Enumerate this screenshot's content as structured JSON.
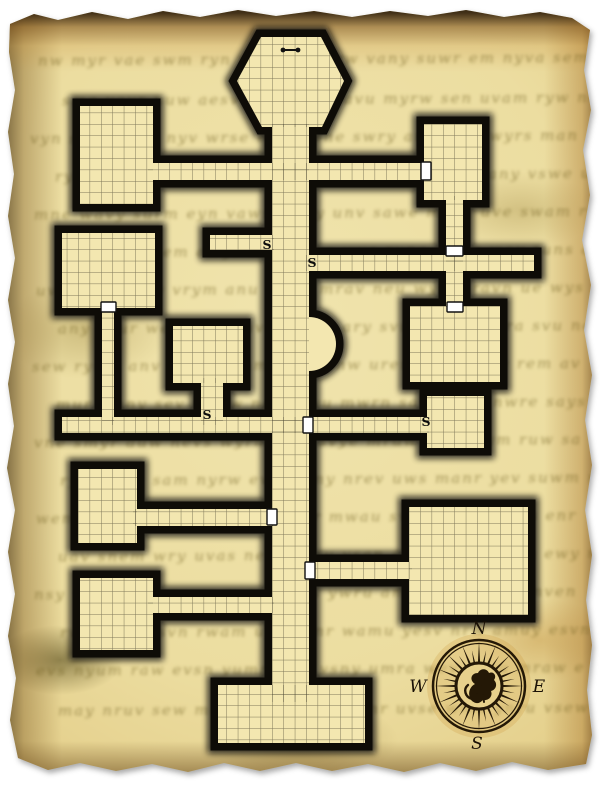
{
  "parchment": {
    "scribbles": [
      {
        "x": 38,
        "y": 50,
        "text": "nw myr vae swm ryn wav emsy rw vany suwr em nyva sem"
      },
      {
        "x": 62,
        "y": 90,
        "text": "sma veyr nuw aesv rym wens avu myrw sen uvam ryw nes"
      },
      {
        "x": 30,
        "y": 128,
        "text": "vyn sewr amu nyv wrse mya uvne swry ame nvu wyrs man"
      },
      {
        "x": 55,
        "y": 166,
        "text": "ryw vanu mes wyra nuv semw ary vnes muw rany vswe um"
      },
      {
        "x": 34,
        "y": 204,
        "text": "mne wavy surm eyn vaws remy unv sawe myrn uve swam r"
      },
      {
        "x": 60,
        "y": 242,
        "text": "wsa nyru vem awys rnu mevs wya rune mvsa wey runs av"
      },
      {
        "x": 36,
        "y": 280,
        "text": "uvr mayn sew vrym anu wsey mrav neu wysm ravn ue wys"
      },
      {
        "x": 58,
        "y": 318,
        "text": "any vsur wem nyra uvs mewn ary svum enw myra svu nem"
      },
      {
        "x": 32,
        "y": 356,
        "text": "sew ryum anv weys runm ave synw urem avy nsuw rem av"
      },
      {
        "x": 56,
        "y": 394,
        "text": "mur wany sev rumw nays evu mwrn saye uvm nwre says u"
      },
      {
        "x": 34,
        "y": 432,
        "text": "vne smyr auw nevs wyrm uan svye mruw ans veym ruw sa"
      },
      {
        "x": 60,
        "y": 470,
        "text": "ryn wuve sam nyrw evu samy nrev uws manr yev suwm ra"
      },
      {
        "x": 36,
        "y": 508,
        "text": "wem rauv sny werm auvs enyr mwau svne yrmw avus enr"
      },
      {
        "x": 58,
        "y": 546,
        "text": "uav snem wry uvas nemw ryu vsan emwy rvu sanm ewy rv"
      },
      {
        "x": 34,
        "y": 584,
        "text": "nsy wrua mve nsyw ruam vens ywru amve nsw yrua mven"
      },
      {
        "x": 60,
        "y": 622,
        "text": "rwa muye svn rwam uyes vnr wamu yesv nrw amuy esvn r"
      },
      {
        "x": 36,
        "y": 660,
        "text": "evs nyum raw evsn yumr awe vsny umra wev snyu mraw e"
      },
      {
        "x": 58,
        "y": 700,
        "text": "may nruv sew mayn ruvs ewm aynr uvse wma ynru vsew m"
      }
    ]
  },
  "map": {
    "wall_color": "#0e0c07",
    "floor_color": "#f3e7b0",
    "grid_color": "rgba(50,46,32,0.6)",
    "grid_size": 11.4,
    "grid_origin": {
      "x": 272,
      "y": 124
    },
    "door_fill": "#ffffff",
    "door_stroke": "#111111",
    "secret_door_label": "S",
    "shapes": [
      {
        "id": "hex-chamber",
        "kind": "polygon",
        "pts": "261,37 321,37 344,81 322,127 262,127 237,81"
      },
      {
        "id": "room-top-left",
        "kind": "rect",
        "x": 80,
        "y": 106,
        "w": 73,
        "h": 98
      },
      {
        "id": "room-top-right",
        "kind": "rect",
        "x": 424,
        "y": 124,
        "w": 58,
        "h": 76
      },
      {
        "id": "room-left-mid",
        "kind": "rect",
        "x": 62,
        "y": 233,
        "w": 93,
        "h": 75
      },
      {
        "id": "room-center-left",
        "kind": "rect",
        "x": 173,
        "y": 326,
        "w": 70,
        "h": 57
      },
      {
        "id": "room-right-mid",
        "kind": "rect",
        "x": 410,
        "y": 306,
        "w": 90,
        "h": 76
      },
      {
        "id": "room-right-small",
        "kind": "rect",
        "x": 427,
        "y": 396,
        "w": 57,
        "h": 52
      },
      {
        "id": "room-bottom-left-upper",
        "kind": "rect",
        "x": 78,
        "y": 469,
        "w": 59,
        "h": 74
      },
      {
        "id": "room-bottom-left-lower",
        "kind": "rect",
        "x": 80,
        "y": 578,
        "w": 73,
        "h": 72
      },
      {
        "id": "room-bottom-right",
        "kind": "rect",
        "x": 409,
        "y": 507,
        "w": 119,
        "h": 108
      },
      {
        "id": "room-bottom-center",
        "kind": "rect",
        "x": 218,
        "y": 685,
        "w": 147,
        "h": 58
      },
      {
        "id": "corridor-main",
        "kind": "rect",
        "x": 272,
        "y": 124,
        "w": 37,
        "h": 578
      },
      {
        "id": "corridor-top",
        "kind": "rect",
        "x": 148,
        "y": 163,
        "w": 278,
        "h": 17
      },
      {
        "id": "corridor-topright-down",
        "kind": "rect",
        "x": 446,
        "y": 196,
        "w": 17,
        "h": 116
      },
      {
        "id": "corridor-right-upper",
        "kind": "rect",
        "x": 306,
        "y": 255,
        "w": 228,
        "h": 16
      },
      {
        "id": "corridor-stub",
        "kind": "rect",
        "x": 210,
        "y": 235,
        "w": 64,
        "h": 15
      },
      {
        "id": "corridor-long",
        "kind": "rect",
        "x": 62,
        "y": 417,
        "w": 367,
        "h": 16
      },
      {
        "id": "corridor-left-down",
        "kind": "rect",
        "x": 102,
        "y": 305,
        "w": 12,
        "h": 120
      },
      {
        "id": "corridor-centerleft-down",
        "kind": "rect",
        "x": 201,
        "y": 378,
        "w": 22,
        "h": 47
      },
      {
        "id": "corridor-bl-upper",
        "kind": "rect",
        "x": 133,
        "y": 509,
        "w": 141,
        "h": 17
      },
      {
        "id": "corridor-bl-lower",
        "kind": "rect",
        "x": 148,
        "y": 597,
        "w": 126,
        "h": 16
      },
      {
        "id": "corridor-bottom-right",
        "kind": "rect",
        "x": 306,
        "y": 562,
        "w": 106,
        "h": 17
      },
      {
        "id": "alcove",
        "kind": "path",
        "d": "M 309 317 A 27 27 0 0 1 309 371 Z",
        "grid": false
      }
    ],
    "doors": [
      {
        "x": 421,
        "y": 162,
        "w": 10,
        "h": 18
      },
      {
        "x": 446,
        "y": 246,
        "w": 17,
        "h": 10
      },
      {
        "x": 447,
        "y": 302,
        "w": 16,
        "h": 10
      },
      {
        "x": 101,
        "y": 302,
        "w": 15,
        "h": 10
      },
      {
        "x": 303,
        "y": 417,
        "w": 10,
        "h": 16
      },
      {
        "x": 267,
        "y": 509,
        "w": 10,
        "h": 16
      },
      {
        "x": 305,
        "y": 562,
        "w": 10,
        "h": 17
      }
    ],
    "secret_doors": [
      {
        "x": 267,
        "y": 249
      },
      {
        "x": 312,
        "y": 267
      },
      {
        "x": 207,
        "y": 419
      },
      {
        "x": 426,
        "y": 426
      }
    ],
    "feature_marker": {
      "x1": 283,
      "y1": 50,
      "x2": 298,
      "y2": 50,
      "dot_radius": 2.4
    },
    "compass": {
      "cx": 479,
      "cy": 686,
      "outer_r": 46,
      "ring_r": 42.5,
      "hub_r": 23,
      "rays": 32,
      "color": "#241806",
      "hub_fill": "#e7d08c",
      "labels": {
        "north": "N",
        "west": "W",
        "east": "E",
        "south": "S"
      }
    }
  }
}
